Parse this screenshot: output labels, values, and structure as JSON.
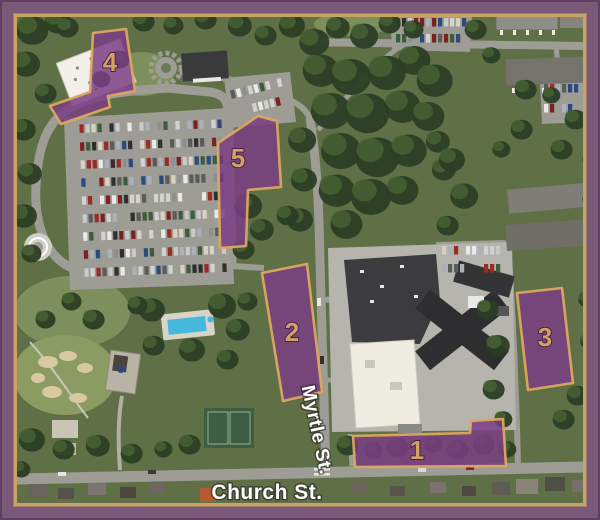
{
  "map": {
    "name": "Aerial campus map with numbered shuttle parking zones",
    "streets": [
      {
        "name": "Myrtle St."
      },
      {
        "name": "Church St."
      }
    ],
    "zones": [
      {
        "number": "1",
        "points": "353,436 470,433 471,421 503,419 506,466 355,467",
        "label_x": 417,
        "label_y": 459
      },
      {
        "number": "2",
        "points": "262,273 307,264 322,392 283,401",
        "label_x": 292,
        "label_y": 341
      },
      {
        "number": "3",
        "points": "517,293 562,288 573,383 528,390",
        "label_x": 545,
        "label_y": 346
      },
      {
        "number": "4",
        "points": "93,33 126,29 135,91 108,96 110,107 61,124 50,106 90,92",
        "label_x": 110,
        "label_y": 71
      },
      {
        "number": "5",
        "points": "218,143 258,116 277,121 281,187 248,190 246,246 220,248",
        "label_x": 238,
        "label_y": 167
      }
    ],
    "colors": {
      "zone_fill": "#7b3d84",
      "zone_border": "#dca85e",
      "zone_number": "#d2a360",
      "frame_outer": "#7a5878",
      "frame_line": "#c9a464",
      "street_label": "#ffffff"
    }
  }
}
